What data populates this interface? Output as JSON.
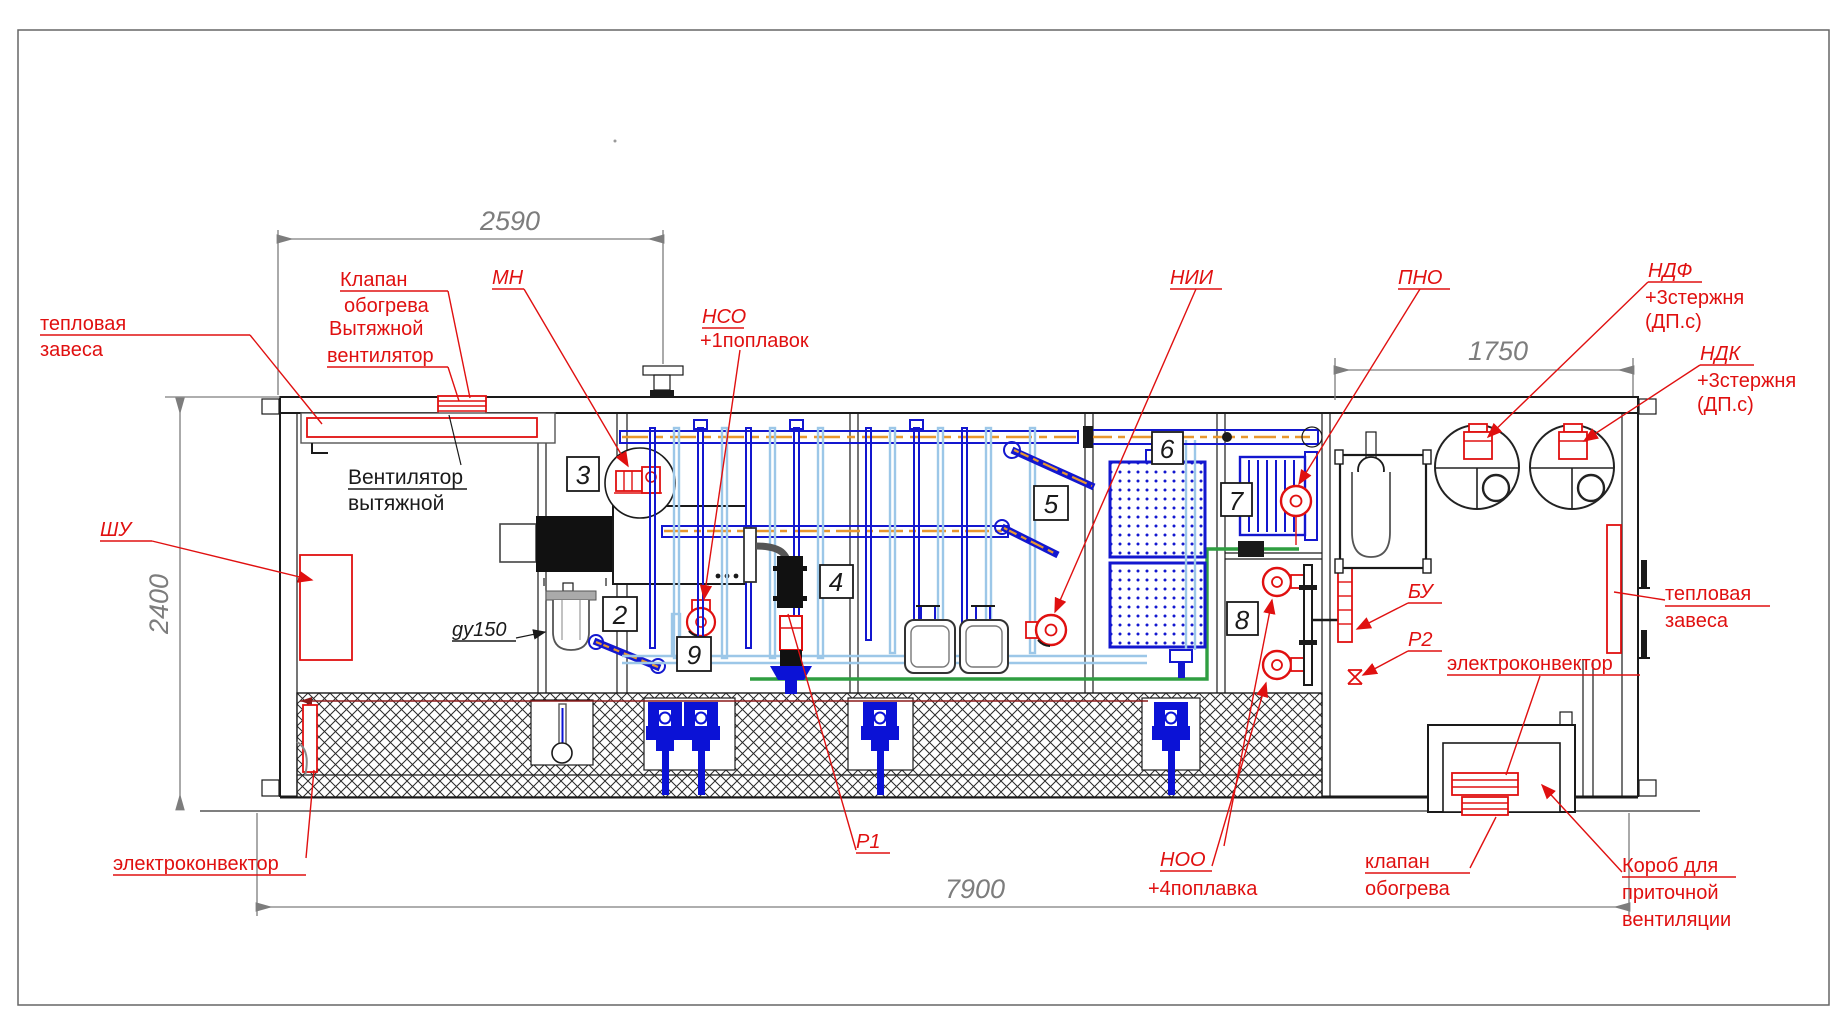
{
  "drawing": {
    "type": "equipment-container-elevation",
    "language": "ru"
  },
  "dimensions": {
    "top_width": "2590",
    "right_width": "1750",
    "height": "2400",
    "total_length": "7900"
  },
  "positions": {
    "p2": "2",
    "p3": "3",
    "p4": "4",
    "p5": "5",
    "p6": "6",
    "p7": "7",
    "p8": "8",
    "p9": "9"
  },
  "labels": {
    "thermal_curtain_left_1": "тепловая",
    "thermal_curtain_left_2": "завеса",
    "heating_valve_top_1": "Клапан",
    "heating_valve_top_2": "обогрева",
    "exhaust_fan_red_1": "Вытяжной",
    "exhaust_fan_red_2": "вентилятор",
    "exhaust_fan_black_1": "Вентилятор",
    "exhaust_fan_black_2": "вытяжной",
    "mn": "МН",
    "nso": "НСО",
    "nso_note": "+1поплавок",
    "nii": "НИИ",
    "pno": "ПНО",
    "ndf": "НДФ",
    "ndf_note1": "+3стержня",
    "ndf_note2": "(ДП.с)",
    "ndk": "НДК",
    "ndk_note1": "+3стержня",
    "ndk_note2": "(ДП.с)",
    "shu": "ШУ",
    "du150": "gy150",
    "bu": "БУ",
    "r2": "Р2",
    "r1": "Р1",
    "noo": "НОО",
    "noo_note": "+4поплавка",
    "thermal_curtain_right_1": "тепловая",
    "thermal_curtain_right_2": "завеса",
    "convector_right": "электроконвектор",
    "convector_left": "электроконвектор",
    "heating_valve_bottom_1": "клапан",
    "heating_valve_bottom_2": "обогрева",
    "duct_1": "Короб для",
    "duct_2": "приточной",
    "duct_3": "вентиляции"
  },
  "colors": {
    "callout_red": "#e01010",
    "equipment_blue": "#1317cf",
    "pipe_light_blue": "#9cc7e8",
    "air_pipe_orange": "#e8972e",
    "pipe_green": "#2f9e41",
    "dimension_gray": "#7d7d7d"
  }
}
